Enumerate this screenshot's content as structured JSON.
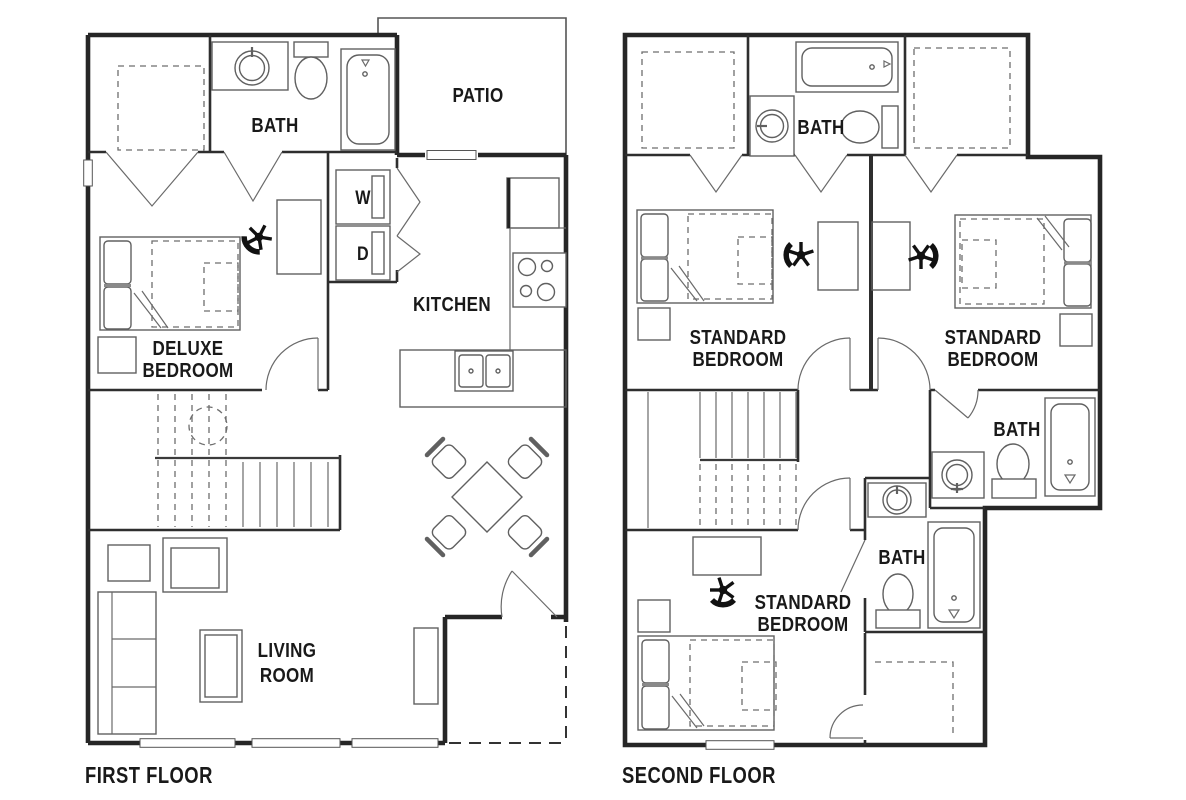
{
  "colors": {
    "background": "#ffffff",
    "walls": "#262626",
    "fixtures": "#606060",
    "text": "#191919"
  },
  "floors": {
    "first": {
      "label": "FIRST FLOOR",
      "rooms": {
        "bath": "BATH",
        "patio": "PATIO",
        "washer": "W",
        "dryer": "D",
        "kitchen": "KITCHEN",
        "deluxe_line1": "DELUXE",
        "deluxe_line2": "BEDROOM",
        "living_line1": "LIVING",
        "living_line2": "ROOM"
      }
    },
    "second": {
      "label": "SECOND FLOOR",
      "rooms": {
        "bath_top": "BATH",
        "bath_mid": "BATH",
        "bath_lower": "BATH",
        "bed_left_line1": "STANDARD",
        "bed_left_line2": "BEDROOM",
        "bed_right_line1": "STANDARD",
        "bed_right_line2": "BEDROOM",
        "bed_bottom_line1": "STANDARD",
        "bed_bottom_line2": "BEDROOM"
      }
    }
  }
}
